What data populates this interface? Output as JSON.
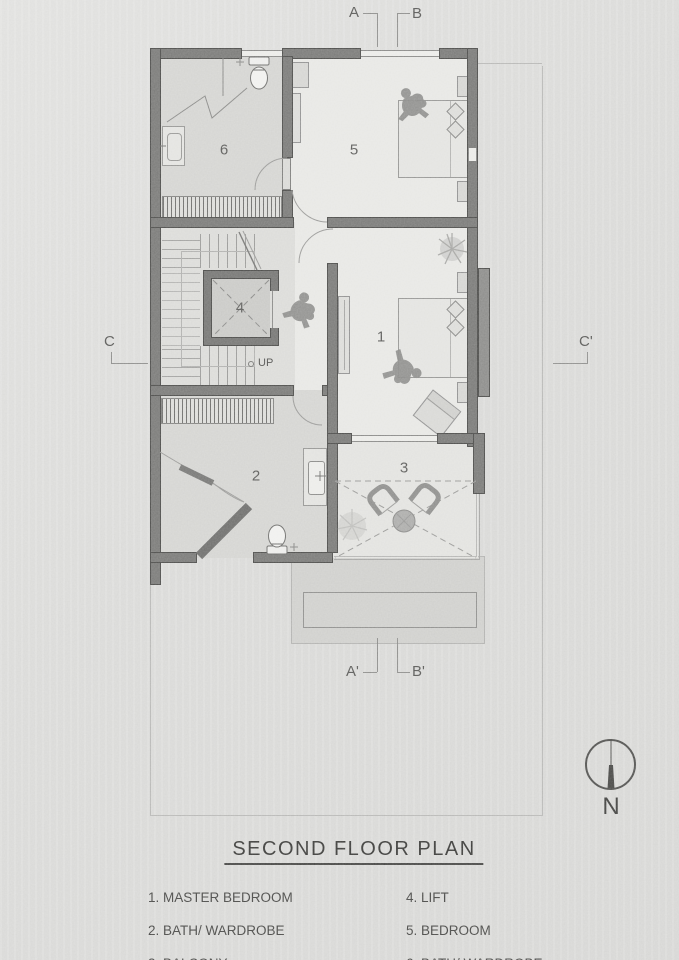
{
  "title": {
    "text": "SECOND FLOOR PLAN"
  },
  "legend": {
    "left": [
      "1. MASTER BEDROOM",
      "2. BATH/ WARDROBE",
      "3. BALCONY"
    ],
    "right": [
      "4. LIFT",
      "5. BEDROOM",
      "6. BATH/ WARDROBE"
    ]
  },
  "rooms": [
    {
      "number": "1",
      "name": "MASTER BEDROOM"
    },
    {
      "number": "2",
      "name": "BATH/ WARDROBE"
    },
    {
      "number": "3",
      "name": "BALCONY"
    },
    {
      "number": "4",
      "name": "LIFT"
    },
    {
      "number": "5",
      "name": "BEDROOM"
    },
    {
      "number": "6",
      "name": "BATH/ WARDROBE"
    }
  ],
  "section_markers": {
    "a": "A",
    "b": "B",
    "a_prime": "A'",
    "b_prime": "B'",
    "c": "C",
    "c_prime": "C'"
  },
  "annotations": {
    "stair_direction": "UP"
  },
  "compass": {
    "north_label": "N"
  },
  "colors": {
    "wall": "#7a7a78",
    "wall_outline": "#4e4e4c",
    "room_light": "#e7e7e4",
    "room_dark": "#d4d4d1",
    "paper": "#dcdcd9",
    "linework": "#9a9a98",
    "text": "#4c4c4a"
  }
}
